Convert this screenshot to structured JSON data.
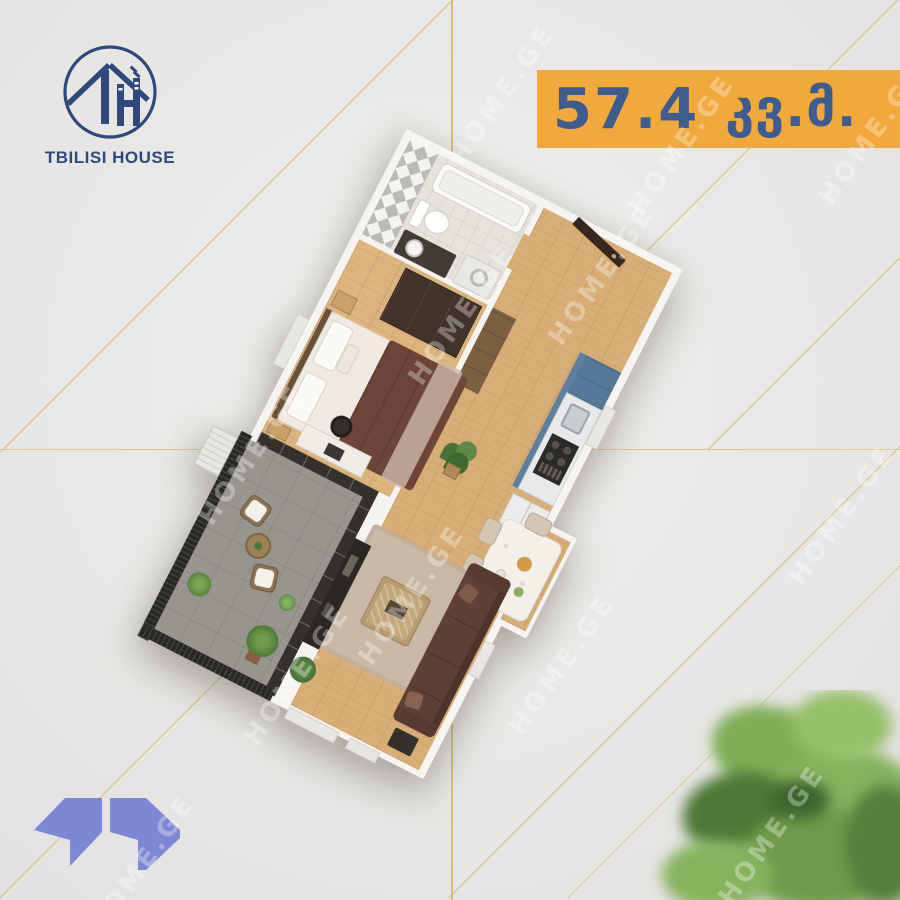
{
  "brand": {
    "name": "TBILISI HOUSE",
    "monogram": "TH",
    "color": "#2e4a7c"
  },
  "area_badge": {
    "value": "57.4",
    "unit": "კვ.მ.",
    "bg_color": "#f1a93c",
    "text_color": "#3d5c8f"
  },
  "watermark": {
    "text": "HOME.GE"
  },
  "decor": {
    "line_color": "#d6b56b",
    "logo_mark_color": "#7c87d6",
    "background_color": "#e9e8e6"
  },
  "floor_plan": {
    "type": "apartment-3d-top-view",
    "rotation_deg": 27,
    "rooms": [
      {
        "name": "bathroom",
        "features": [
          "bathtub",
          "toilet",
          "vanity-basin",
          "washing-machine",
          "mosaic-tile-wall"
        ]
      },
      {
        "name": "entry-hall",
        "features": [
          "entry-door",
          "hall-cabinet"
        ]
      },
      {
        "name": "bedroom",
        "features": [
          "double-bed",
          "wardrobe",
          "nightstands",
          "desk",
          "desk-chair"
        ]
      },
      {
        "name": "kitchen",
        "features": [
          "blue-cabinets",
          "sink",
          "stove",
          "fridge"
        ]
      },
      {
        "name": "dining-area",
        "features": [
          "dining-table",
          "chairs",
          "bay-window"
        ]
      },
      {
        "name": "living-room",
        "features": [
          "sofa",
          "rug",
          "coffee-table",
          "tv-console",
          "plant"
        ]
      },
      {
        "name": "balcony",
        "features": [
          "railing",
          "wicker-chairs",
          "round-table",
          "plants",
          "glazing",
          "ac-unit"
        ]
      }
    ],
    "palette": {
      "wood_floor": "#d8ae76",
      "walls": "#f6f4f1",
      "kitchen_cabinets": "#5d80a0",
      "sofa": "#5f4035",
      "bed_blanket": "#6e4639",
      "balcony_floor": "#98958f",
      "rug": "#c9b8a4",
      "entry_door": "#37281f"
    }
  }
}
